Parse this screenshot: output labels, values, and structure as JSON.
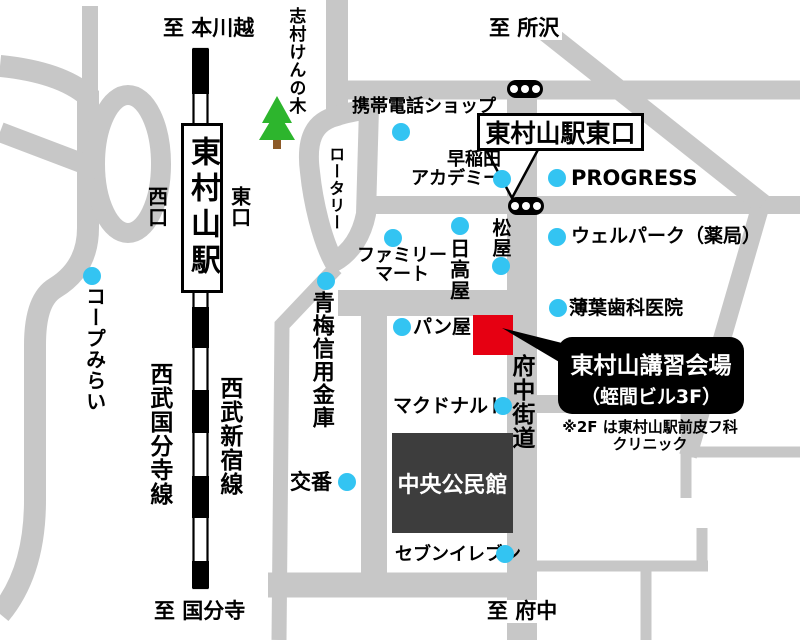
{
  "directions": {
    "hongawagoe": "至 本川越",
    "tokorozawa": "至 所沢",
    "kokubunji": "至 国分寺",
    "fuchu": "至 府中"
  },
  "station": {
    "name": "東村山駅",
    "west_exit": "西口",
    "east_exit": "東口",
    "east_exit_sign": "東村山駅東口"
  },
  "railways": {
    "kokubunji_line": "西武国分寺線",
    "shinjuku_line": "西武新宿線"
  },
  "roads": {
    "rotary": "ロータリー",
    "fuchu_kaido": "府中街道"
  },
  "nature": {
    "tree_label": "志村けんの木"
  },
  "venue": {
    "callout_title": "東村山講習会場",
    "callout_subtitle": "（蛭間ビル3F）",
    "note_line1": "※2F は東村山駅前皮フ科",
    "note_line2": "クリニック"
  },
  "landmarks": {
    "mobile_shop": "携帯電話ショップ",
    "waseda_line1": "早稲田",
    "waseda_line2": "アカデミー",
    "progress": "PROGRESS",
    "welpark": "ウェルパーク（薬局）",
    "matsuya": "松屋",
    "hidakaya": "日高屋",
    "familymart_line1": "ファミリー",
    "familymart_line2": "マート",
    "usuba_dental": "薄葉歯科医院",
    "bakery": "パン屋",
    "mcdonalds": "マクドナルド",
    "coop_mirai": "コープみらい",
    "ome_shinkin": "青梅信用金庫",
    "koban": "交番",
    "seven_eleven": "セブンイレブン",
    "community_center": "中央公民館"
  },
  "colors": {
    "road": "#c7c7c7",
    "venue_red": "#e60012",
    "landmark_dot": "#33c4f2",
    "building_dark": "#3d3d3d",
    "tree_green": "#2db52d"
  }
}
